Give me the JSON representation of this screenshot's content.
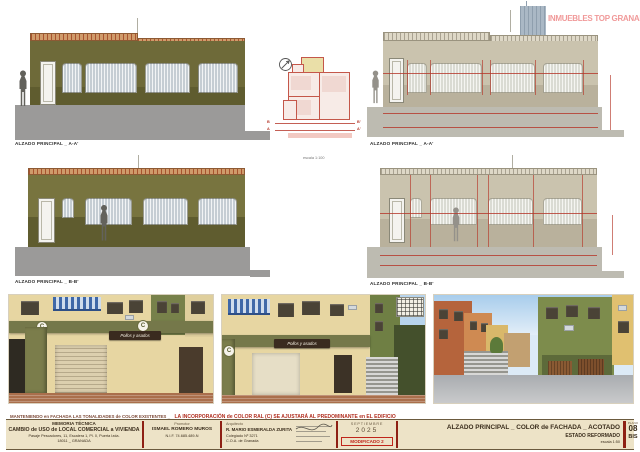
{
  "labels": {
    "elev_a_left": "ALZADO PRINCIPAL _ A-A'",
    "elev_a_right": "ALZADO PRINCIPAL _ A-A'",
    "elev_b_left": "ALZADO PRINCIPAL _ B-B'",
    "elev_b_right": "ALZADO PRINCIPAL _ B-B'"
  },
  "plan": {
    "scale": "escala 1:100",
    "marker_b": "B",
    "marker_b2": "B'",
    "marker_a": "A",
    "marker_a2": "A'"
  },
  "watermark": "INMUEBLES TOP GRANADA",
  "photos": {
    "badge": "C",
    "sign_text": "Pollos y asados",
    "caption_prefix": "MANTENIENDO en FACHADA LAS TONALIDADES de COLOR EXISTENTES _",
    "caption_main": "LA INCORPORACIÓN de COLOR RAL (C) SE AJUSTARÁ AL PREDOMINANTE en EL EDIFICIO"
  },
  "titleblock": {
    "project_label": "MEMORIA TÉCNICA",
    "project_title": "CAMBIO de USO de LOCAL COMERCIAL a VIVIENDA",
    "address_line1": "Pasaje Pescadores, 11, Escalera 1, Pl. 0, Puerta Izda.",
    "address_line2": "18011 _ GRANADA",
    "promoter_label": "Promotor",
    "promoter_name": "ISMAEL ROMERO MUROS",
    "promoter_nif": "N.I.F. 74.685.489-N",
    "architect_label": "Arquitecto",
    "architect_name": "R. MARIO ESMERALDA ZURITA",
    "architect_line2": "Colegiado Nº 3271",
    "architect_line3": "C.O.A. de Granada",
    "date_month": "SEPTIEMBRE",
    "date_year": "2025",
    "modified": "MODIFICADO 2",
    "sheet_title": "ALZADO PRINCIPAL _ COLOR de FACHADA _ ACOTADO",
    "sheet_subtitle": "ESTADO REFORMADO",
    "sheet_scale": "escala 1:50",
    "plate_label": "PLANO",
    "plate_number": "08",
    "plate_suffix": "BIS"
  },
  "colors": {
    "olive_wall": "#6e6a39",
    "beige_wall": "#cac3ae",
    "dimension_red": "#b5372a",
    "watermark_pink": "#ef8f8f",
    "titleblock_bg": "#ede3c7",
    "divider_red": "#8e2014",
    "modified_red": "#c0251a"
  }
}
